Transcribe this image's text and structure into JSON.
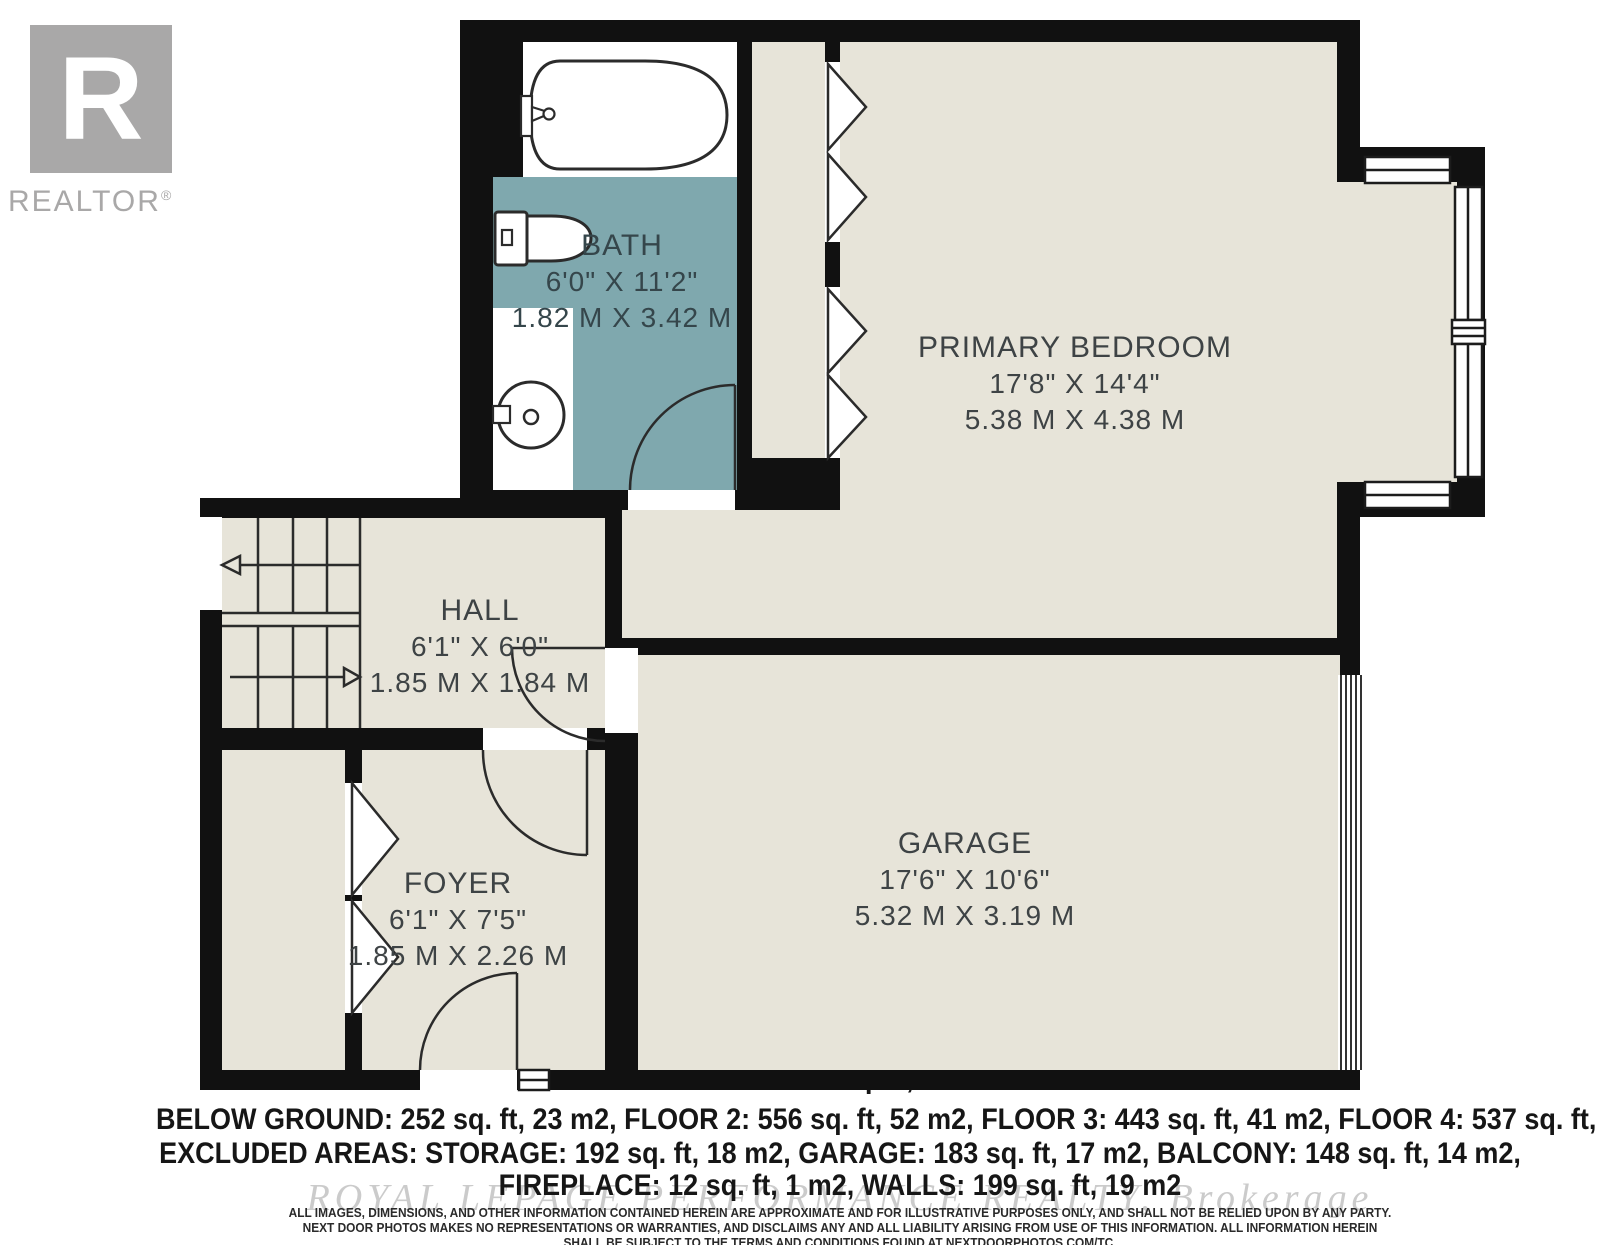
{
  "branding": {
    "logo_letter": "R",
    "logo_name": "REALTOR",
    "logo_reg": "®"
  },
  "rooms": {
    "bath": {
      "name": "BATH",
      "imperial": "6'0\" X 11'2\"",
      "metric": "1.82 M X 3.42 M"
    },
    "primary_bedroom": {
      "name": "PRIMARY BEDROOM",
      "imperial": "17'8\" X 14'4\"",
      "metric": "5.38 M X 4.38 M"
    },
    "hall": {
      "name": "HALL",
      "imperial": "6'1\" X 6'0\"",
      "metric": "1.85 M X 1.84 M"
    },
    "foyer": {
      "name": "FOYER",
      "imperial": "6'1\" X 7'5\"",
      "metric": "1.85 M X 2.26 M"
    },
    "garage": {
      "name": "GARAGE",
      "imperial": "17'6\" X 10'6\"",
      "metric": "5.32 M X 3.19 M"
    }
  },
  "summary": {
    "total": "TOTAL: 1788 sq. ft, 166 m2",
    "line2": "BELOW GROUND: 252 sq. ft, 23 m2, FLOOR 2: 556 sq. ft, 52 m2, FLOOR 3: 443 sq. ft, 41 m2, FLOOR 4: 537 sq. ft, 50 m2",
    "line3": "EXCLUDED AREAS: STORAGE: 192 sq. ft, 18 m2, GARAGE: 183 sq. ft, 17 m2, BALCONY: 148 sq. ft, 14 m2,",
    "line4": "FIREPLACE: 12 sq. ft, 1 m2, WALLS: 199 sq. ft, 19 m2"
  },
  "watermark": "ROYAL LEPAGE PERFORMANCE REALTY, Brokerage",
  "disclaimer": {
    "line1": "ALL IMAGES, DIMENSIONS, AND OTHER INFORMATION CONTAINED HEREIN ARE APPROXIMATE AND FOR ILLUSTRATIVE PURPOSES ONLY, AND SHALL NOT BE RELIED UPON BY ANY PARTY.",
    "line2": "NEXT DOOR PHOTOS MAKES NO REPRESENTATIONS OR WARRANTIES, AND DISCLAIMS ANY AND ALL LIABILITY ARISING FROM USE OF THIS INFORMATION. ALL INFORMATION HEREIN",
    "line3": "SHALL BE SUBJECT TO THE TERMS AND CONDITIONS FOUND AT NEXTDOORPHOTOS.COM/TC."
  },
  "colors": {
    "wall": "#111111",
    "floor_beige": "#e7e4d9",
    "bath_teal": "#7fa8ae",
    "logo_gray": "#a9a8a8",
    "label_text": "#3e4345",
    "watermark_gray": "#cbcbcb"
  }
}
